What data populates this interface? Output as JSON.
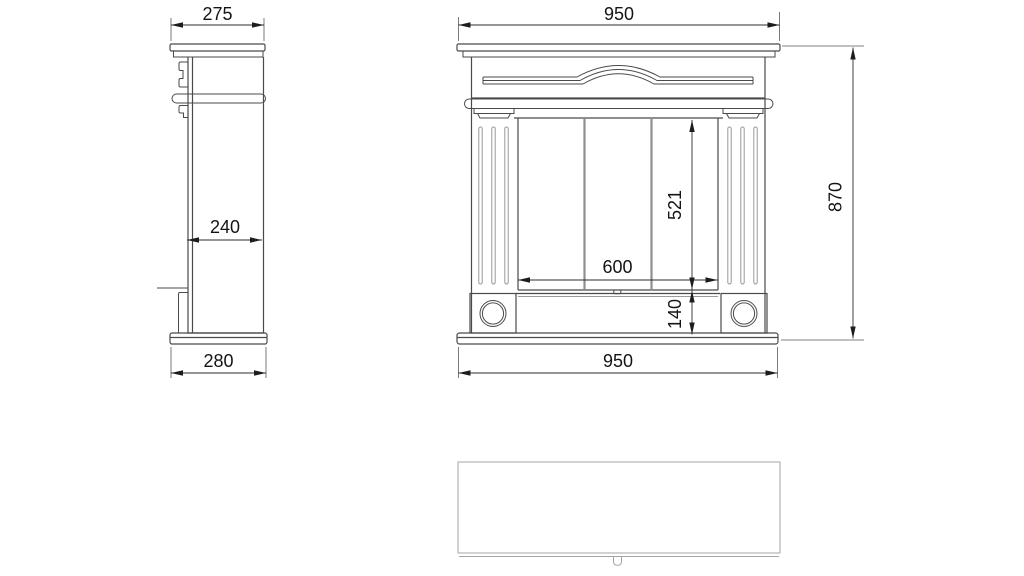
{
  "drawing_type": "fireplace-mantel-orthographic-views",
  "dims": {
    "side_top_width": "275",
    "side_body_depth": "240",
    "side_base_depth": "280",
    "front_top_width": "950",
    "front_opening_width": "600",
    "front_opening_height": "521",
    "front_plinth_height": "140",
    "front_base_width": "950",
    "front_total_height": "870"
  },
  "colors": {
    "background": "#ffffff",
    "outline": "#4a4a4a",
    "light_detail": "#9a9a9a",
    "panel_division": "#8f8f8f",
    "dimension_line": "#2e2e2e",
    "text": "#141414"
  }
}
